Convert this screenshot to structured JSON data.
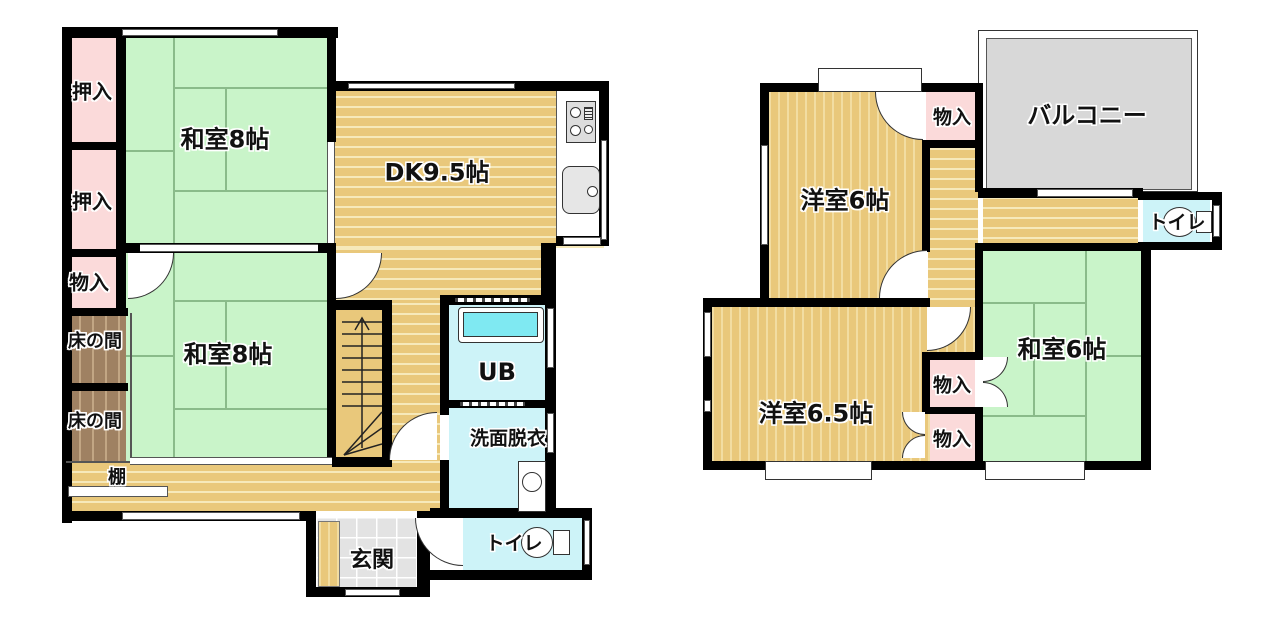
{
  "floor1": {
    "oshiire1": "押入",
    "oshiire2": "押入",
    "monoiri": "物入",
    "tokonoma1": "床の間",
    "tokonoma2": "床の間",
    "tana": "棚",
    "washitsu8a": "和室8帖",
    "washitsu8b": "和室8帖",
    "dk": "DK9.5帖",
    "ub": "UB",
    "senmen": "洗面脱衣",
    "toilet": "トイレ",
    "genkan": "玄関"
  },
  "floor2": {
    "yoshitsu6": "洋室6帖",
    "monoiri_top": "物入",
    "balcony": "バルコニー",
    "toilet": "トイレ",
    "washitsu6": "和室6帖",
    "yoshitsu65": "洋室6.5帖",
    "monoiri_mid": "物入",
    "monoiri_bot": "物入"
  },
  "colors": {
    "tatami": "#c9f4c9",
    "wood": "#e9c87b",
    "wood-stripe": "#f6e9ba",
    "closet": "#fbdada",
    "wet": "#cdf3f8",
    "tokonoma": "#9f8162",
    "balcony": "#d8d8d8",
    "wall": "#000000"
  }
}
